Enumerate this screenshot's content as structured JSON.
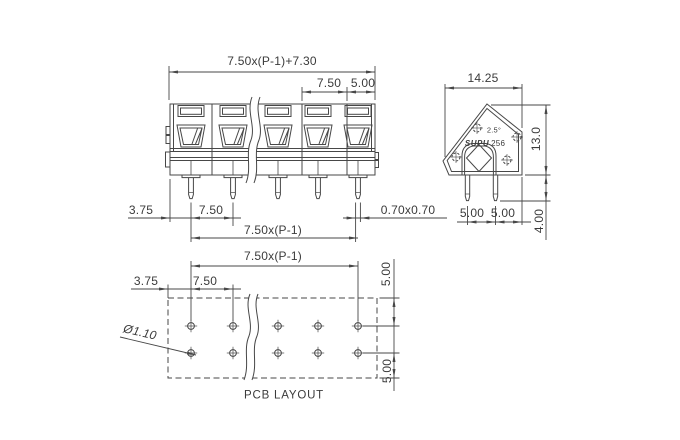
{
  "front_view": {
    "dim_total": "7.50x(P-1)+7.30",
    "dim_pitch": "7.50",
    "dim_end": "5.00",
    "dim_left_offset": "3.75",
    "dim_pin_pitch": "7.50",
    "dim_pin_size": "0.70x0.70",
    "dim_span": "7.50x(P-1)"
  },
  "side_view": {
    "dim_width": "14.25",
    "dim_height": "13.0",
    "dim_pin_length": "4.00",
    "dim_pin_spacing_1": "5.00",
    "dim_pin_spacing_2": "5.00",
    "angle": "2.5°",
    "brand": "SUPU",
    "model": "256"
  },
  "pcb_layout": {
    "title": "PCB LAYOUT",
    "dim_span": "7.50x(P-1)",
    "dim_left_offset": "3.75",
    "dim_pitch": "7.50",
    "dim_row_top": "5.00",
    "dim_row_bottom": "5.00",
    "hole_diameter": "Ø1.10"
  },
  "colors": {
    "line": "#474747",
    "text": "#3b3b3b",
    "background": "#ffffff"
  }
}
